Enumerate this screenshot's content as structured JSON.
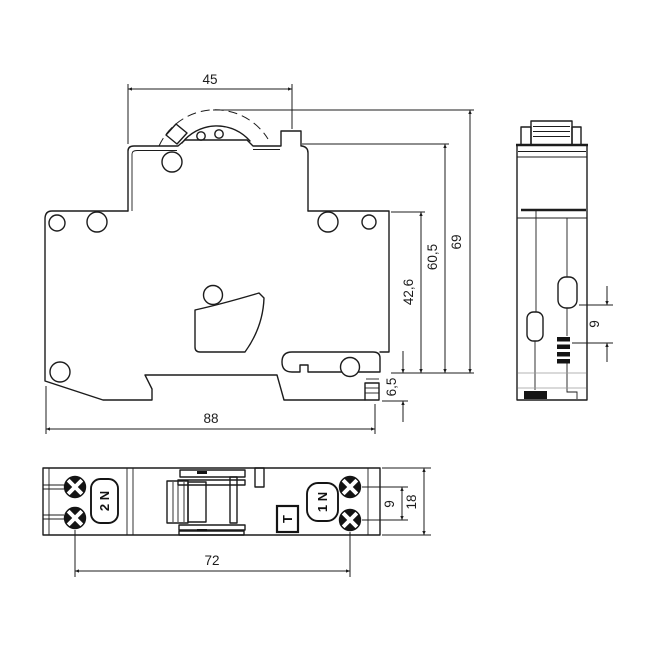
{
  "colors": {
    "line": "#1c1c1c",
    "background": "#ffffff"
  },
  "main_view": {
    "dims": {
      "width_top": "45",
      "height_total": "69",
      "height_60_5": "60,5",
      "height_42_6": "42,6",
      "clip_depth": "6,5",
      "width_total": "88"
    }
  },
  "side_view": {
    "dims": {
      "offset_9": "9"
    }
  },
  "bottom_view": {
    "dims": {
      "screw_span": "72",
      "screw_gap": "9",
      "module_width": "18"
    },
    "labels": {
      "terminal_left": "2 N",
      "terminal_right": "1 N",
      "test_button": "T"
    }
  }
}
